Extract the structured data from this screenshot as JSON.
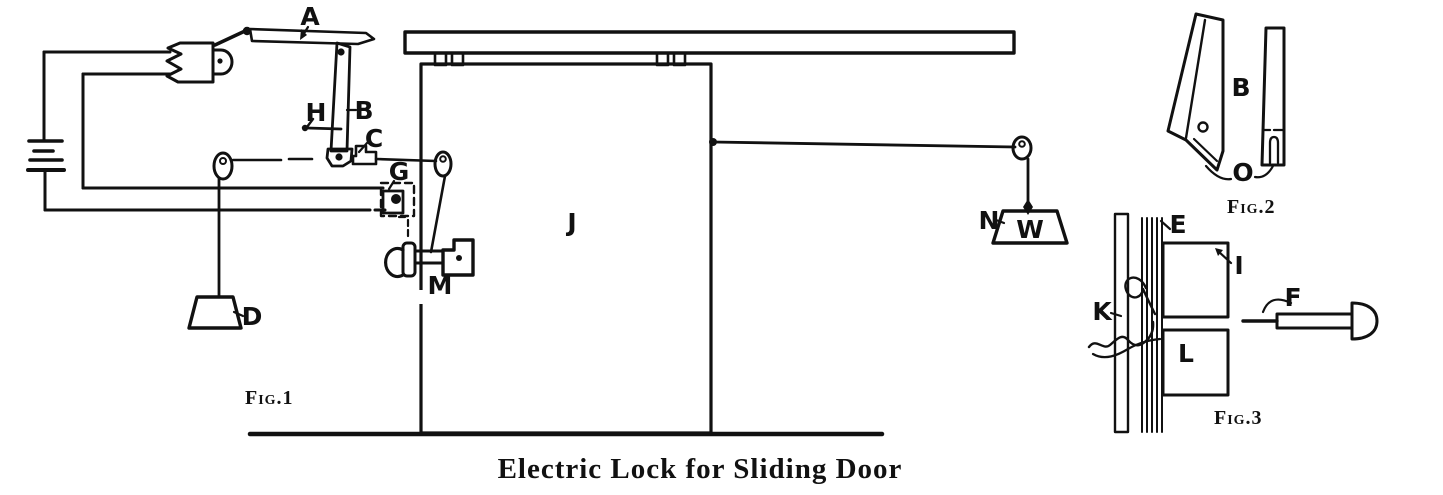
{
  "caption": "Electric Lock for Sliding Door",
  "colors": {
    "ink": "#111111",
    "paper": "#ffffff"
  },
  "fig1": {
    "caption": "Fig.1",
    "labels": {
      "A": "A",
      "H": "H",
      "B": "B",
      "C": "C",
      "G": "G",
      "J": "J",
      "M": "M",
      "D": "D",
      "N": "N",
      "W": "W"
    }
  },
  "fig2": {
    "caption": "Fig.2",
    "labels": {
      "B": "B",
      "O": "O"
    }
  },
  "fig3": {
    "caption": "Fig.3",
    "labels": {
      "E": "E",
      "I": "I",
      "K": "K",
      "F": "F",
      "L": "L"
    }
  }
}
